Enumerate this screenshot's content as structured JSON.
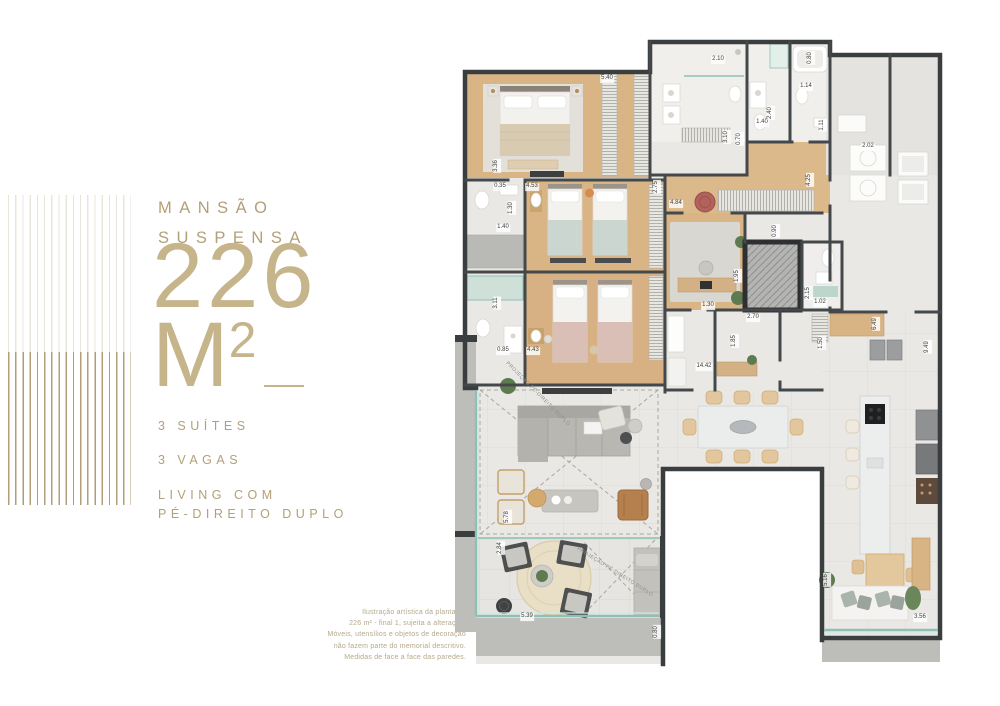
{
  "brand": {
    "title_line1": "MANSÃO",
    "title_line2": "SUSPENSA",
    "area_value": "226",
    "area_unit_main": "M",
    "area_unit_exp": "2",
    "features": [
      "3 SUÍTES",
      "3 VAGAS",
      "LIVING COM\nPÉ-DIREITO DUPLO"
    ]
  },
  "disclaimer_lines": [
    "Ilustração artística da planta de",
    "226 m² - final 1, sujeita a alteração.",
    "Móveis, utensílios e objetos de decoração",
    "não fazem parte do memorial descritivo.",
    "Medidas de face a face das paredes."
  ],
  "colors": {
    "gold": "#b2a078",
    "gold_light": "#c6b48b",
    "wall": "#3e4142",
    "wood": "#d9b586",
    "tile": "#e9e8e5",
    "glass": "#8fc0b6",
    "accent_red": "#b2625c",
    "plant_green": "#5e7b50"
  },
  "plan": {
    "projection_label": "PROJEÇÃO PÉ-DIREITO DUPLO",
    "projections": [
      {
        "x": 88,
        "y": 364,
        "r": 45
      },
      {
        "x": 165,
        "y": 542,
        "r": 32
      }
    ],
    "dimensions": [
      {
        "t": "5.40",
        "x": 157,
        "y": 49,
        "r": 0
      },
      {
        "t": "3.36",
        "x": 47,
        "y": 136,
        "r": -90
      },
      {
        "t": "0.35",
        "x": 50,
        "y": 157,
        "r": 0
      },
      {
        "t": "4.53",
        "x": 82,
        "y": 157,
        "r": 0
      },
      {
        "t": "1.30",
        "x": 62,
        "y": 178,
        "r": -90
      },
      {
        "t": "1.40",
        "x": 53,
        "y": 198,
        "r": 0
      },
      {
        "t": "2.75",
        "x": 207,
        "y": 157,
        "r": -90
      },
      {
        "t": "4.84",
        "x": 226,
        "y": 174,
        "r": 0
      },
      {
        "t": "2.10",
        "x": 268,
        "y": 30,
        "r": 0
      },
      {
        "t": "3.10",
        "x": 277,
        "y": 107,
        "r": -90
      },
      {
        "t": "0.70",
        "x": 290,
        "y": 109,
        "r": -90
      },
      {
        "t": "1.40",
        "x": 312,
        "y": 93,
        "r": 0
      },
      {
        "t": "2.40",
        "x": 321,
        "y": 83,
        "r": -90
      },
      {
        "t": "1.14",
        "x": 356,
        "y": 57,
        "r": 0
      },
      {
        "t": "0.80",
        "x": 361,
        "y": 28,
        "r": -90
      },
      {
        "t": "1.11",
        "x": 373,
        "y": 95,
        "r": -90
      },
      {
        "t": "2.02",
        "x": 418,
        "y": 117,
        "r": 0
      },
      {
        "t": "4.25",
        "x": 360,
        "y": 150,
        "r": -90
      },
      {
        "t": "0.90",
        "x": 326,
        "y": 201,
        "r": -90
      },
      {
        "t": "1.95",
        "x": 288,
        "y": 246,
        "r": -90
      },
      {
        "t": "2.15",
        "x": 359,
        "y": 263,
        "r": -90
      },
      {
        "t": "1.02",
        "x": 370,
        "y": 273,
        "r": 0
      },
      {
        "t": "1.30",
        "x": 258,
        "y": 276,
        "r": 0
      },
      {
        "t": "2.70",
        "x": 303,
        "y": 288,
        "r": 0
      },
      {
        "t": "1.85",
        "x": 285,
        "y": 311,
        "r": -90
      },
      {
        "t": "1.50",
        "x": 372,
        "y": 313,
        "r": -90
      },
      {
        "t": "14.42",
        "x": 254,
        "y": 337,
        "r": 0
      },
      {
        "t": "6.49",
        "x": 426,
        "y": 294,
        "r": -90
      },
      {
        "t": "9.49",
        "x": 478,
        "y": 317,
        "r": -90
      },
      {
        "t": "3.11",
        "x": 47,
        "y": 273,
        "r": -90
      },
      {
        "t": "0.85",
        "x": 53,
        "y": 321,
        "r": 0
      },
      {
        "t": "4.43",
        "x": 83,
        "y": 321,
        "r": 0
      },
      {
        "t": "5.78",
        "x": 58,
        "y": 487,
        "r": -90
      },
      {
        "t": "2.84",
        "x": 51,
        "y": 518,
        "r": -90
      },
      {
        "t": "5.39",
        "x": 77,
        "y": 587,
        "r": 0
      },
      {
        "t": "0.80",
        "x": 207,
        "y": 602,
        "r": -90
      },
      {
        "t": "5.16",
        "x": 377,
        "y": 550,
        "r": -90
      },
      {
        "t": "3.56",
        "x": 470,
        "y": 588,
        "r": 0
      }
    ]
  }
}
